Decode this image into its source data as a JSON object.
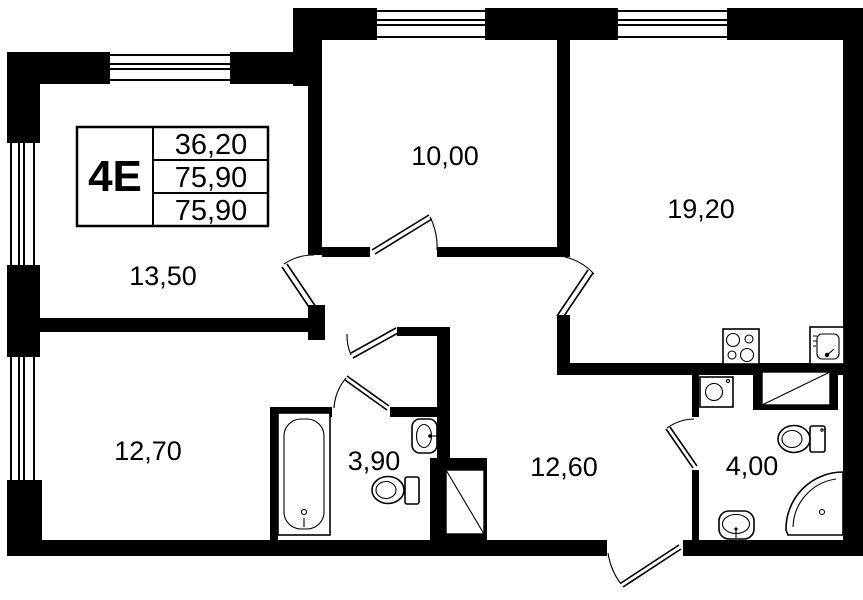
{
  "plan": {
    "background": "#ffffff",
    "line_color": "#000000",
    "title_block": {
      "unit_type": "4E",
      "rows": [
        "36,20",
        "75,90",
        "75,90"
      ]
    },
    "room_labels": {
      "room_13_50": "13,50",
      "room_10_00": "10,00",
      "room_19_20": "19,20",
      "room_12_70": "12,70",
      "bathroom_3_90": "3,90",
      "hallway_12_60": "12,60",
      "bathroom_4_00": "4,00"
    }
  }
}
